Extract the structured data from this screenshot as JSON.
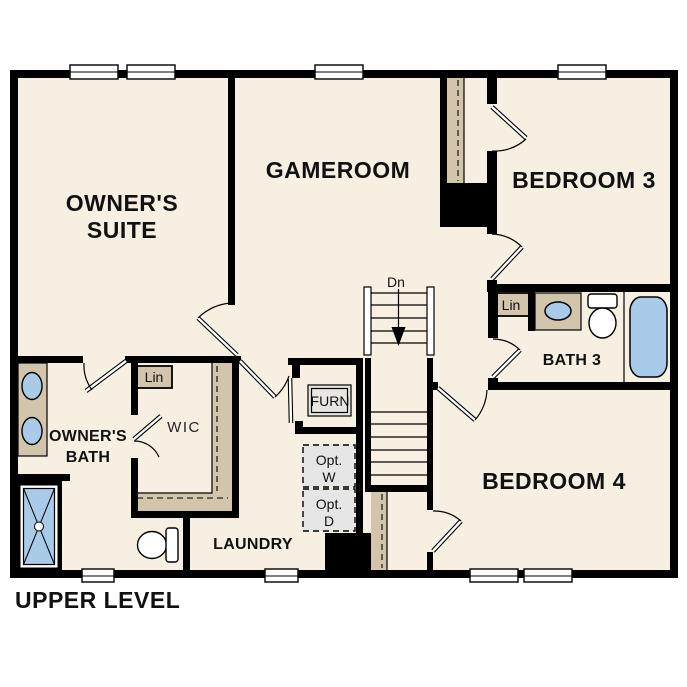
{
  "title": {
    "text": "UPPER LEVEL"
  },
  "rooms": {
    "owners_suite": {
      "line1": "OWNER'S",
      "line2": "SUITE"
    },
    "gameroom": {
      "label": "GAMEROOM"
    },
    "bedroom3": {
      "label": "BEDROOM 3"
    },
    "bedroom4": {
      "label": "BEDROOM 4"
    },
    "bath3": {
      "label": "BATH 3"
    },
    "owners_bath": {
      "line1": "OWNER'S",
      "line2": "BATH"
    },
    "wic": {
      "label": "WIC"
    },
    "laundry": {
      "label": "LAUNDRY"
    }
  },
  "closets": {
    "lin_wic": "Lin",
    "lin_bath3": "Lin"
  },
  "fixtures": {
    "furnace": "FURN",
    "opt_washer": {
      "line1": "Opt.",
      "line2": "W"
    },
    "opt_dryer": {
      "line1": "Opt.",
      "line2": "D"
    }
  },
  "stairs": {
    "direction": "Dn"
  },
  "colors": {
    "background": "#ffffff",
    "floor": "#f6efe2",
    "wall": "#000000",
    "shelf": "#d2c5ab",
    "water": "#a9cae8",
    "opt_box": "#e6e6e6",
    "furn_box": "#e7e6e1"
  }
}
